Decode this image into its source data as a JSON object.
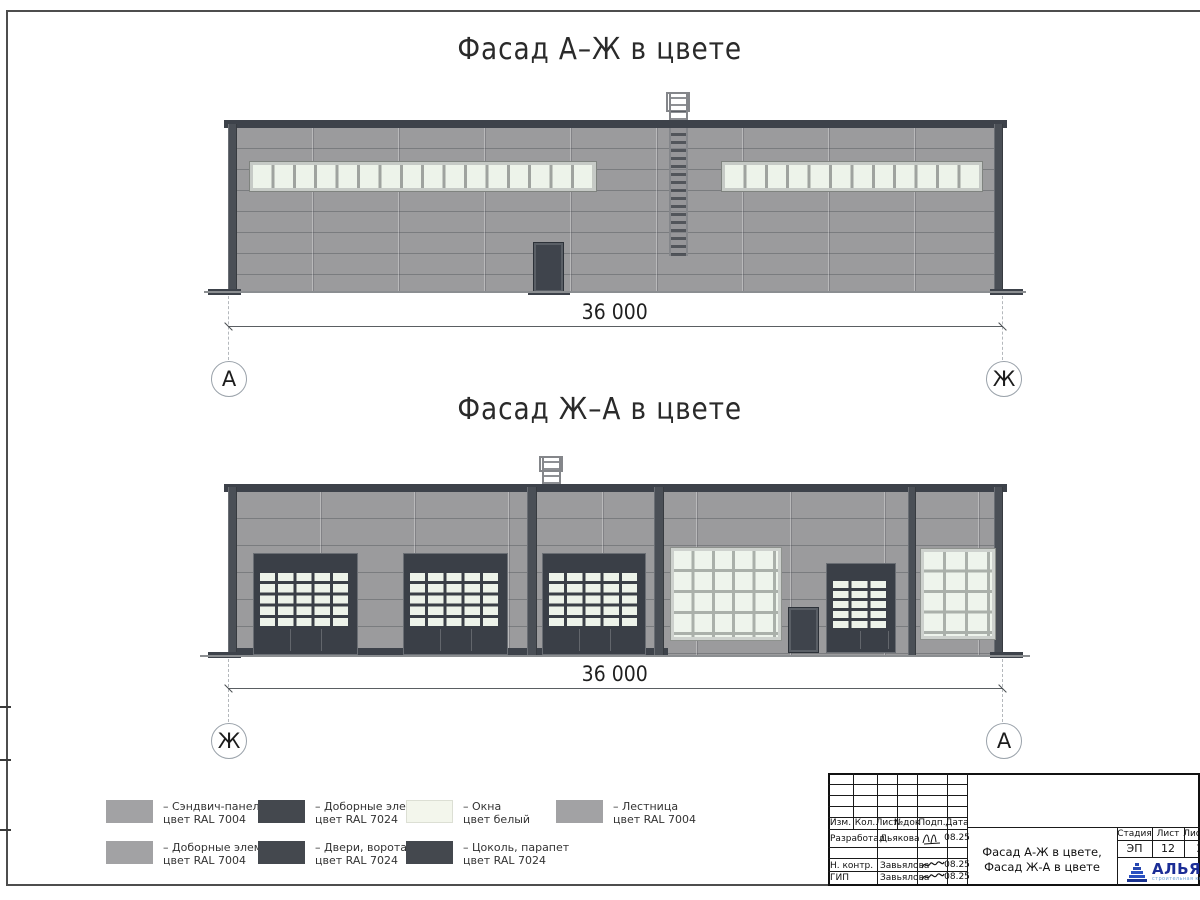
{
  "drawings": {
    "top": {
      "title": "Фасад А–Ж в цвете",
      "dimension": "36 000",
      "axis_left": "А",
      "axis_right": "Ж"
    },
    "bottom": {
      "title": "Фасад Ж–А в цвете",
      "dimension": "36 000",
      "axis_left": "Ж",
      "axis_right": "А"
    }
  },
  "legend": {
    "items": [
      {
        "line1": "– Сэндвич-панели",
        "line2": "цвет RAL 7004",
        "swatch": "#a2a2a4"
      },
      {
        "line1": "– Доборные элементы",
        "line2": "цвет RAL 7024",
        "swatch": "#44484e"
      },
      {
        "line1": "– Окна",
        "line2": "цвет белый",
        "swatch": "#f3f6ec"
      },
      {
        "line1": "– Лестница",
        "line2": "цвет RAL 7004",
        "swatch": "#a2a2a4"
      },
      {
        "line1": "– Доборные элементы",
        "line2": "цвет RAL 7004",
        "swatch": "#a2a2a4"
      },
      {
        "line1": "– Двери, ворота",
        "line2": "цвет RAL 7024",
        "swatch": "#44484e"
      },
      {
        "line1": "– Цоколь, парапет",
        "line2": "цвет RAL 7024",
        "swatch": "#44484e"
      }
    ]
  },
  "title_block": {
    "cols": {
      "izm": "Изм.",
      "kol": "Кол.",
      "list": "Лист",
      "ndok": "№док",
      "podp": "Подп.",
      "data": "Дата"
    },
    "rows": [
      {
        "role": "Разработал",
        "name": "Дьякова",
        "date": "08.25"
      },
      {
        "role": "Н. контр.",
        "name": "Завьялова",
        "date": "08.25"
      },
      {
        "role": "ГИП",
        "name": "Завьялова",
        "date": "08.25"
      }
    ],
    "doc_title": {
      "line1": "Фасад А-Ж в цвете,",
      "line2": "Фасад Ж-А в цвете"
    },
    "stage": {
      "label": "Стадия",
      "value": "ЭП"
    },
    "sheet": {
      "label": "Лист",
      "value": "12"
    },
    "sheets": {
      "label": "Листов",
      "value": "2"
    },
    "logo": {
      "text": "АЛЬЯН",
      "subtext": "строительная комп"
    }
  },
  "colors": {
    "sandwich_panel": "#9b9b9d",
    "dark_elements": "#3f444c",
    "window_white": "#eef3ea",
    "ground": "#8b8e91"
  }
}
